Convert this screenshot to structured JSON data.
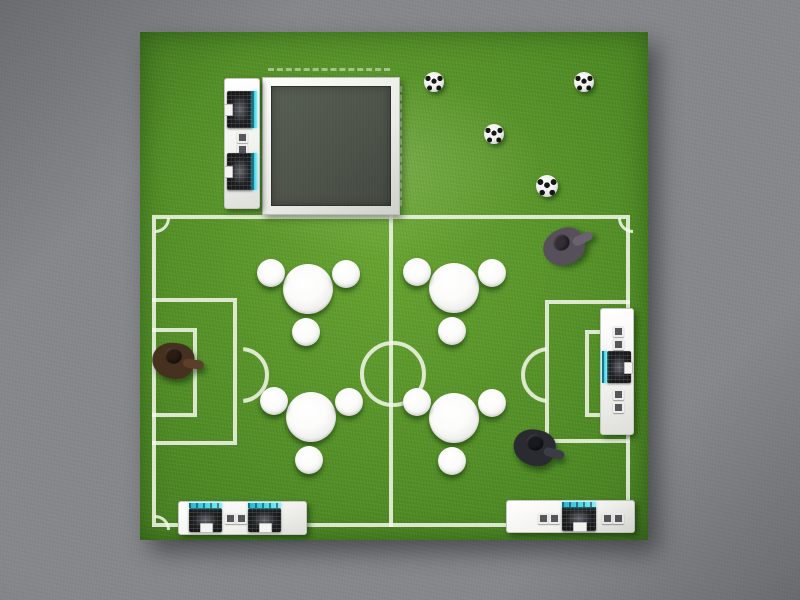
{
  "scene": {
    "title": "Top view 3D render of a soccer themed exhibition booth",
    "description": "Square artificial grass pitch with white football markings laid on grey concrete; arched goal with net and footballs at top right, framed dark platform with reception counters at top left, four round table clusters with stools, laptop counters along the edges and three visitors walking on the pitch",
    "colors": {
      "floor": "#85878b",
      "floor_dark": "#6c6e72",
      "grass": "#4e8a24",
      "grass_light": "#68a531",
      "grass_dark": "#3a6b1c",
      "line": "#f3f6ea",
      "line_rgba": "rgba(244,248,236,0.85)",
      "platform_top": "#4d5349",
      "frame_white": "#e9e9e6",
      "counter_white": "#f2f2ef",
      "laptop_dark": "#18191b",
      "screen_cyan": "#45d6e6",
      "ball_white": "#fbfbfa",
      "ball_black": "#161616",
      "table_white": "#fbfbfa"
    },
    "pitch": {
      "label": "football-pitch-markings",
      "features": [
        "boundary",
        "halfway-line",
        "centre-circle",
        "left-penalty-area",
        "left-goal-area",
        "left-penalty-arc",
        "right-penalty-area",
        "right-goal-area",
        "right-penalty-arc",
        "corner-arcs"
      ]
    },
    "goal": {
      "label": "goal-with-arched-net",
      "parts": [
        "net",
        "left-post",
        "right-post",
        "crossbar"
      ]
    },
    "table_radius": 25,
    "stool_radius": 14,
    "stool_offsets": [
      {
        "dx": -37,
        "dy": -16
      },
      {
        "dx": 38,
        "dy": -15
      },
      {
        "dx": -2,
        "dy": 43
      }
    ],
    "tables": [
      {
        "label": "table-cluster-upper-left",
        "cx": 308,
        "cy": 289
      },
      {
        "label": "table-cluster-upper-right",
        "cx": 454,
        "cy": 288
      },
      {
        "label": "table-cluster-lower-left",
        "cx": 311,
        "cy": 417
      },
      {
        "label": "table-cluster-lower-right",
        "cx": 454,
        "cy": 418
      }
    ],
    "balls": [
      {
        "label": "football-in-net-left",
        "cx": 434,
        "cy": 82,
        "r": 10
      },
      {
        "label": "football-in-net-right",
        "cx": 584,
        "cy": 82,
        "r": 10
      },
      {
        "label": "football-at-goal-line",
        "cx": 494,
        "cy": 134,
        "r": 10
      },
      {
        "label": "football-midfield",
        "cx": 547,
        "cy": 186,
        "r": 11
      }
    ],
    "people": [
      {
        "label": "visitor-top-right",
        "cx": 566,
        "cy": 247,
        "rot": -25,
        "body": "#57505a",
        "head": "#332e35",
        "limb": "#6a6270"
      },
      {
        "label": "visitor-left",
        "cx": 175,
        "cy": 362,
        "rot": 8,
        "body": "#46301f",
        "head": "#2a1c12",
        "limb": "#5a3f2a"
      },
      {
        "label": "visitor-bottom-right",
        "cx": 536,
        "cy": 449,
        "rot": 15,
        "body": "#2a2a31",
        "head": "#191920",
        "limb": "#3c3c45"
      }
    ],
    "counters": [
      {
        "label": "counter-beside-platform",
        "stations": 2
      },
      {
        "label": "counter-bottom-left",
        "stations": 2
      },
      {
        "label": "counter-bottom-right",
        "stations": 1
      },
      {
        "label": "counter-right-edge",
        "stations": 1
      }
    ]
  }
}
